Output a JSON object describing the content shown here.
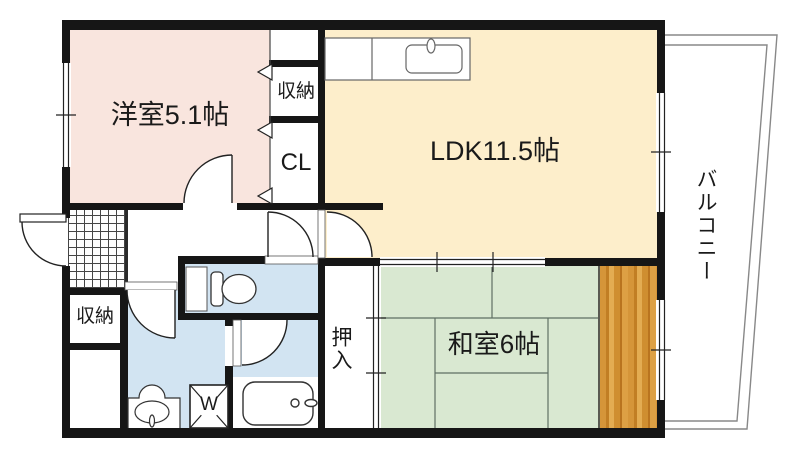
{
  "floorplan": {
    "rooms": {
      "western_room": "洋室5.1帖",
      "ldk": "LDK11.5帖",
      "japanese_room": "和室6帖",
      "balcony": "バルコニー",
      "closet_top": "収納",
      "closet_cl": "CL",
      "storage_left": "収納",
      "oshiire": "押入",
      "washing_machine": "W"
    },
    "colors": {
      "western_room_floor": "#f9e5de",
      "ldk_floor": "#fdeecb",
      "japanese_room_floor": "#d9e8d1",
      "wet_area_floor": "#d2e4f2",
      "wood_deck": "#d59539",
      "wall": "#161616"
    }
  }
}
